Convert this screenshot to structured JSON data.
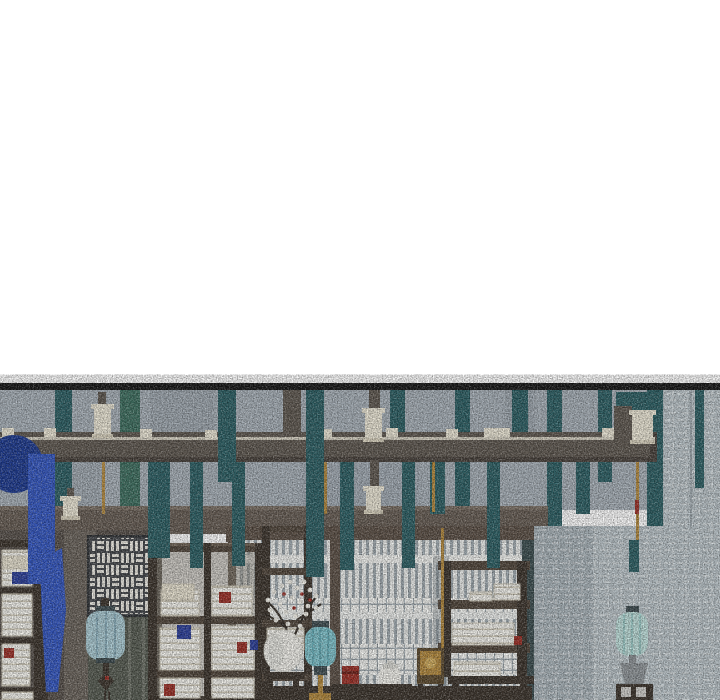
{
  "palette": {
    "white_bg": "#ffffff",
    "ink": "#171717",
    "ceiling": "#a7b0b8",
    "ceiling_dark": "#97a1a8",
    "beam": "#5f5850",
    "beam_dark": "#49423c",
    "beam_line": "#e9e4d4",
    "lintel": "#675d54",
    "lintel_hi": "#7a6f64",
    "wall_left": "#57504a",
    "pillar": "#6b645c",
    "door_olive": "#565b51",
    "door_line": "#70746a",
    "wall_right": "#a8b3b9",
    "wall_right_light": "#bac4c9",
    "window_bg": "#edefed",
    "slat": "#a0aab0",
    "band_white": "#f4f5f2",
    "frame_brown": "#5c5046",
    "frame_teal": "#3c4e50",
    "teal": "#2c5f64",
    "teal_green": "#3e6f60",
    "blue": "#3457c1",
    "navy": "#1d3a90",
    "cream": "#ece7d6",
    "cream_dark": "#d8d1bd",
    "wood": "#51463b",
    "wood_light": "#6d6052",
    "wood_dark": "#3c342c",
    "book": "#f5f4ee",
    "book_edge": "#cfc9b8",
    "book_cream": "#e7e1cf",
    "red": "#9c2f26",
    "red_dark": "#6e1f18",
    "book_blue": "#2c3f9b",
    "celadon1": "#7fc3cc",
    "celadon1_rib": "#5da5b0",
    "celadon2": "#bfe0dc",
    "celadon2_rib": "#8fc3c0",
    "lantern_blue": "#aacbd4",
    "lantern_blue_rib": "#7ea4b4",
    "lantern_cap": "#3e4c50",
    "gold": "#b3893d",
    "gold_light": "#d4af5e",
    "metal": "#8b9094",
    "jar": "#f3f2ec",
    "jar_shade": "#d9d9d3",
    "branch": "#342d26",
    "blossom": "#f2f0e8",
    "fret_bg": "#44474b",
    "fret_white": "#eceae2",
    "shadow": "#6f7a80"
  },
  "scene": {
    "banners_back": [
      {
        "x": 55,
        "y": 390,
        "w": 17,
        "h": 202,
        "c": "teal"
      },
      {
        "x": 120,
        "y": 390,
        "w": 20,
        "h": 178,
        "c": "teal_green"
      },
      {
        "x": 390,
        "y": 390,
        "w": 15,
        "h": 45,
        "c": "teal"
      },
      {
        "x": 455,
        "y": 390,
        "w": 15,
        "h": 182,
        "c": "teal"
      },
      {
        "x": 512,
        "y": 390,
        "w": 16,
        "h": 72,
        "c": "teal"
      },
      {
        "x": 547,
        "y": 390,
        "w": 15,
        "h": 240,
        "c": "teal"
      },
      {
        "x": 598,
        "y": 390,
        "w": 14,
        "h": 92,
        "c": "teal"
      },
      {
        "x": 616,
        "y": 392,
        "w": 44,
        "h": 70,
        "c": "teal"
      },
      {
        "x": 647,
        "y": 390,
        "w": 16,
        "h": 310,
        "c": "teal"
      },
      {
        "x": 695,
        "y": 390,
        "w": 9,
        "h": 98,
        "c": "teal"
      }
    ],
    "banners_front": [
      {
        "x": 148,
        "y": 462,
        "w": 22,
        "h": 96,
        "c": "teal"
      },
      {
        "x": 190,
        "y": 462,
        "w": 13,
        "h": 106,
        "c": "teal"
      },
      {
        "x": 218,
        "y": 390,
        "w": 18,
        "h": 92,
        "c": "teal"
      },
      {
        "x": 232,
        "y": 462,
        "w": 13,
        "h": 104,
        "c": "teal"
      },
      {
        "x": 306,
        "y": 390,
        "w": 18,
        "h": 187,
        "c": "teal"
      },
      {
        "x": 340,
        "y": 462,
        "w": 14,
        "h": 108,
        "c": "teal"
      },
      {
        "x": 402,
        "y": 462,
        "w": 13,
        "h": 106,
        "c": "teal"
      },
      {
        "x": 430,
        "y": 462,
        "w": 15,
        "h": 52,
        "c": "teal"
      },
      {
        "x": 487,
        "y": 462,
        "w": 13,
        "h": 106,
        "c": "teal"
      },
      {
        "x": 576,
        "y": 462,
        "w": 14,
        "h": 52,
        "c": "teal"
      },
      {
        "x": 629,
        "y": 540,
        "w": 10,
        "h": 32,
        "c": "teal"
      }
    ],
    "blue_banner": {
      "circle": {
        "cx": 14,
        "cy": 464,
        "r": 29,
        "c": "navy"
      },
      "strip": {
        "x": 28,
        "y": 454,
        "w": 27,
        "h": 130,
        "c": "blue"
      },
      "taper": {
        "points": "40,560 62,548 66,610 58,692 46,692 42,620",
        "c": "blue"
      }
    },
    "cords": [
      {
        "x": 102,
        "y": 462,
        "w": 3,
        "h": 52,
        "c": "gold"
      },
      {
        "x": 324,
        "y": 462,
        "w": 3,
        "h": 52,
        "c": "gold"
      },
      {
        "x": 432,
        "y": 462,
        "w": 3,
        "h": 50,
        "c": "gold"
      },
      {
        "x": 441,
        "y": 528,
        "w": 3,
        "h": 150,
        "c": "gold"
      },
      {
        "x": 636,
        "y": 462,
        "w": 3,
        "h": 78,
        "c": "gold"
      },
      {
        "x": 635,
        "y": 500,
        "w": 4,
        "h": 14,
        "c": "red"
      }
    ],
    "posts": [
      {
        "x": 98,
        "y": 392,
        "w": 8,
        "h": 14,
        "c": "beam"
      },
      {
        "x": 283,
        "y": 390,
        "w": 18,
        "h": 46,
        "c": "beam"
      },
      {
        "x": 369,
        "y": 390,
        "w": 11,
        "h": 20,
        "c": "beam"
      },
      {
        "x": 370,
        "y": 460,
        "w": 9,
        "h": 28,
        "c": "beam"
      },
      {
        "x": 614,
        "y": 406,
        "w": 18,
        "h": 36,
        "c": "beam"
      },
      {
        "x": 67,
        "y": 488,
        "w": 7,
        "h": 10,
        "c": "beam"
      }
    ],
    "lamps": [
      {
        "x": 94,
        "y": 404,
        "w": 17,
        "h": 34
      },
      {
        "x": 365,
        "y": 408,
        "w": 17,
        "h": 34
      },
      {
        "x": 366,
        "y": 486,
        "w": 15,
        "h": 28
      },
      {
        "x": 632,
        "y": 410,
        "w": 21,
        "h": 34
      },
      {
        "x": 63,
        "y": 496,
        "w": 15,
        "h": 24
      }
    ],
    "beam_dashes": [
      {
        "x": 2,
        "y": 428
      },
      {
        "x": 44,
        "y": 428
      },
      {
        "x": 140,
        "y": 429
      },
      {
        "x": 205,
        "y": 430
      },
      {
        "x": 320,
        "y": 429
      },
      {
        "x": 386,
        "y": 428
      },
      {
        "x": 446,
        "y": 429
      },
      {
        "x": 484,
        "y": 428,
        "w": 26
      },
      {
        "x": 602,
        "y": 428
      },
      {
        "x": 622,
        "y": 428
      }
    ],
    "stacks": [
      {
        "x": 161,
        "y": 590,
        "w": 38,
        "h": 26
      },
      {
        "x": 212,
        "y": 586,
        "w": 40,
        "h": 30
      },
      {
        "x": 160,
        "y": 628,
        "w": 40,
        "h": 42
      },
      {
        "x": 212,
        "y": 626,
        "w": 42,
        "h": 44
      },
      {
        "x": 160,
        "y": 678,
        "w": 40,
        "h": 20
      },
      {
        "x": 212,
        "y": 678,
        "w": 42,
        "h": 20
      },
      {
        "x": 267,
        "y": 628,
        "w": 37,
        "h": 22
      },
      {
        "x": 494,
        "y": 584,
        "w": 26,
        "h": 16
      },
      {
        "x": 470,
        "y": 592,
        "w": 22,
        "h": 9
      },
      {
        "x": 452,
        "y": 623,
        "w": 62,
        "h": 22
      },
      {
        "x": 454,
        "y": 662,
        "w": 46,
        "h": 15
      },
      {
        "x": 2,
        "y": 550,
        "w": 30,
        "h": 36
      },
      {
        "x": 2,
        "y": 594,
        "w": 30,
        "h": 42
      },
      {
        "x": 2,
        "y": 644,
        "w": 28,
        "h": 42
      },
      {
        "x": 2,
        "y": 692,
        "w": 31,
        "h": 8
      }
    ],
    "cream_blocks": [
      {
        "x": 162,
        "y": 584,
        "w": 32,
        "h": 16
      },
      {
        "x": 2,
        "y": 556,
        "w": 28,
        "h": 13
      }
    ],
    "accents": [
      {
        "x": 219,
        "y": 592,
        "w": 12,
        "h": 11,
        "c": "red"
      },
      {
        "x": 177,
        "y": 625,
        "w": 14,
        "h": 14,
        "c": "book_blue"
      },
      {
        "x": 237,
        "y": 642,
        "w": 10,
        "h": 11,
        "c": "red"
      },
      {
        "x": 164,
        "y": 684,
        "w": 11,
        "h": 12,
        "c": "red"
      },
      {
        "x": 250,
        "y": 640,
        "w": 8,
        "h": 10,
        "c": "book_blue"
      },
      {
        "x": 514,
        "y": 636,
        "w": 8,
        "h": 9,
        "c": "red"
      },
      {
        "x": 12,
        "y": 572,
        "w": 16,
        "h": 12,
        "c": "book_blue"
      },
      {
        "x": 4,
        "y": 648,
        "w": 10,
        "h": 10,
        "c": "red"
      }
    ],
    "blossoms_white": [
      [
        268,
        600
      ],
      [
        274,
        592
      ],
      [
        282,
        586
      ],
      [
        290,
        582
      ],
      [
        297,
        588
      ],
      [
        304,
        582
      ],
      [
        310,
        590
      ],
      [
        316,
        596
      ],
      [
        270,
        610
      ],
      [
        280,
        604
      ],
      [
        292,
        598
      ],
      [
        300,
        602
      ],
      [
        308,
        606
      ],
      [
        286,
        612
      ],
      [
        296,
        616
      ],
      [
        306,
        614
      ],
      [
        316,
        608
      ],
      [
        276,
        620
      ],
      [
        288,
        624
      ],
      [
        300,
        626
      ]
    ],
    "blossoms_red": [
      [
        284,
        594
      ],
      [
        302,
        594
      ],
      [
        294,
        608
      ],
      [
        310,
        600
      ]
    ]
  }
}
